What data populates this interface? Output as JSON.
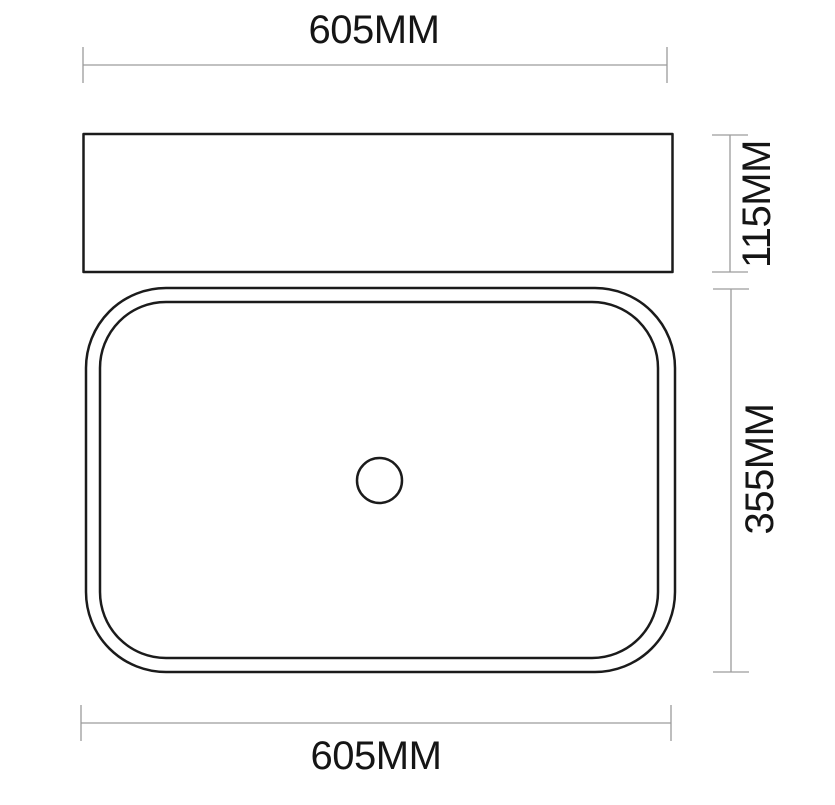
{
  "drawing": {
    "type": "basin technical dimension drawing",
    "labels": {
      "top_width": "605MM",
      "side_height": "115MM",
      "plan_depth": "355MM",
      "bottom_width": "605MM"
    },
    "colors": {
      "outline": "#1b1b1b",
      "dimension": "#9c9c9c",
      "text": "#151515",
      "background": "#ffffff"
    }
  }
}
